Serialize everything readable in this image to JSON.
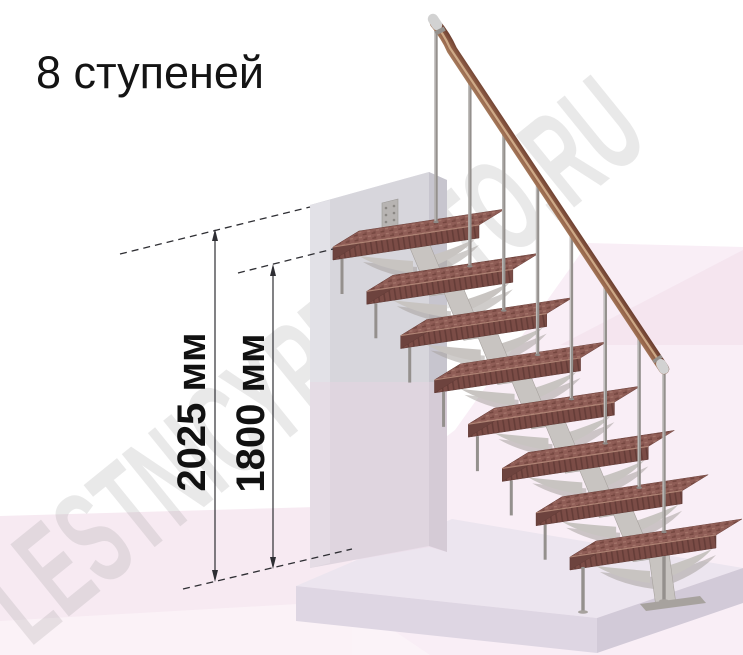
{
  "title": "8 ступеней",
  "watermark": "LESTNICYPROSTO.RU",
  "dimensions": [
    {
      "label": "2025 мм",
      "value_mm": 2025
    },
    {
      "label": "1800 мм",
      "value_mm": 1800
    }
  ],
  "stairs": {
    "step_count": 8,
    "has_handrail": true
  },
  "colors": {
    "tread_top": "#8f5d56",
    "tread_top_dark": "#74463f",
    "tread_top_light": "#a5766b",
    "tread_front": "#7b4c46",
    "tread_grain": "#653d38",
    "tread_end": "#6d433e",
    "tread_edge": "#bb907f",
    "steel": "#c8c4c1",
    "steel_shadow": "#a7a29e",
    "steel_dark": "#8f8b88",
    "baluster": "#94908d",
    "baluster_light": "#d6d4d2",
    "rail_light": "#b08a68",
    "rail_mid": "#96644a",
    "rail_dark": "#66392c",
    "rail_sheen": "#dcbb97",
    "cap": "#d2d2d2",
    "cap_dark": "#95918d",
    "wall_front": "#d7d6dc",
    "wall_side": "#c7c5ce",
    "wall_top": "#edebf1",
    "wall_left": "#e3e2e8",
    "plate": "#b7b4b2",
    "plate_hole": "#8a8784",
    "floor_top": "#ece5ef",
    "floor_left": "#ded6e3",
    "floor_right": "#d2cad8",
    "pink_a": "#f7eaf2",
    "pink_b": "#f9eef6",
    "pink_c": "#f2dfeb",
    "annotation": "#2e2e33"
  }
}
